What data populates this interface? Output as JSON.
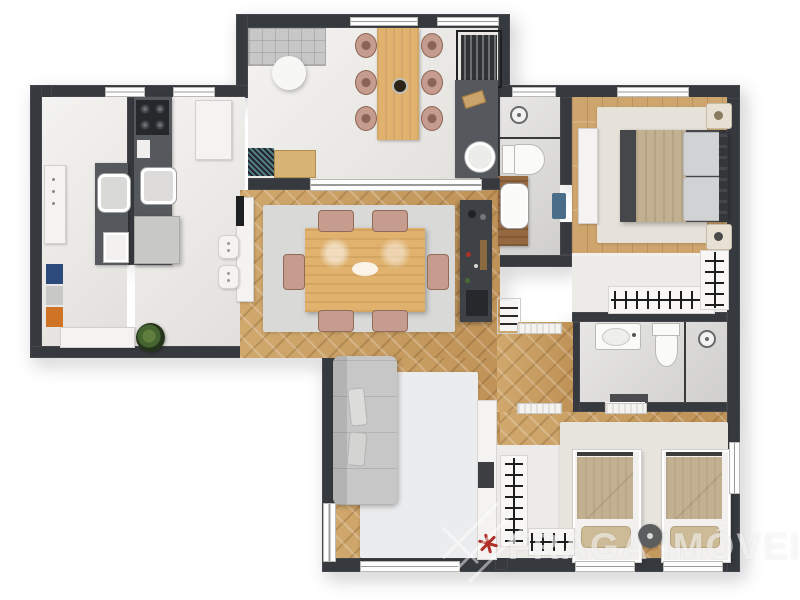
{
  "watermark": {
    "brand": "FRAGA IMÓVEIS",
    "logo": "roof-lines-logo"
  },
  "colors": {
    "wall": "#36393e",
    "tile": "#e9e7e3",
    "bath_tile": "#dbdad8",
    "wood": "#cba267",
    "wood_dark": "#bf9257",
    "counter_dark": "#55585c",
    "cabinet_dark": "#3e4145",
    "sofa_gray": "#c6c7c6",
    "chair_tan": "#c59c8d",
    "table_wood": "#e0b26e",
    "blanket_beige": "#c2b091",
    "bed_frame": "#46474b",
    "mattress": "#d0d2d4",
    "accent_navy": "#2d4a7d",
    "accent_orange": "#cf7426",
    "plant_green": "#44652f",
    "plant_red": "#b03028",
    "mat_blue": "#4a6e8a",
    "vanity_wood": "#96683f"
  },
  "rooms": [
    {
      "id": "gourmet-balcony",
      "items": [
        "outdoor-sofa",
        "round-coffee-table",
        "outdoor-dining-table",
        "outdoor-chairs-x6",
        "barbecue-grill",
        "balcony-counter-sink",
        "decor-console"
      ]
    },
    {
      "id": "laundry-service",
      "items": [
        "washing-machine",
        "laundry-sink-counter",
        "tall-cabinet",
        "laundry-basket"
      ]
    },
    {
      "id": "kitchen",
      "items": [
        "cooktop-4-burners",
        "kitchen-sink",
        "fridge",
        "peninsula-counter",
        "bar-stools-x2",
        "bench",
        "floor-cushions",
        "potted-plant"
      ]
    },
    {
      "id": "dining-room",
      "items": [
        "dining-table",
        "dining-chairs-x6",
        "area-rug",
        "bar-cabinet",
        "shelf-niche"
      ]
    },
    {
      "id": "living-room",
      "items": [
        "sofa",
        "area-rug",
        "tv-panel",
        "tv",
        "red-plant",
        "glass-door"
      ]
    },
    {
      "id": "suite-bathroom",
      "items": [
        "shower",
        "toilet",
        "wood-vanity-sink",
        "blue-bath-mat"
      ]
    },
    {
      "id": "master-bedroom",
      "items": [
        "double-bed",
        "nightstands-x2",
        "dresser",
        "area-rug"
      ]
    },
    {
      "id": "walk-in-closet",
      "items": [
        "hanger-rack-horizontal",
        "hanger-rack-vertical"
      ]
    },
    {
      "id": "bathroom-2",
      "items": [
        "vanity-sink",
        "toilet",
        "shower"
      ]
    },
    {
      "id": "bedroom-2",
      "items": [
        "twin-bed-x2",
        "round-nightstand",
        "closet-racks",
        "area-rug"
      ]
    }
  ]
}
